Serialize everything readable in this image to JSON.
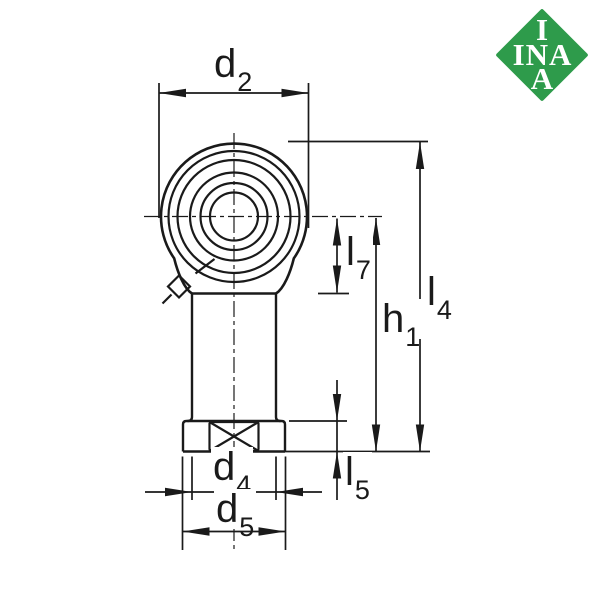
{
  "drawing": {
    "type": "technical-drawing-rod-end-bearing",
    "labels": {
      "d2": {
        "main": "d",
        "sub": "2"
      },
      "l7": {
        "main": "l",
        "sub": "7"
      },
      "h1": {
        "main": "h",
        "sub": "1"
      },
      "l4": {
        "main": "l",
        "sub": "4"
      },
      "l5": {
        "main": "l",
        "sub": "5"
      },
      "d4": {
        "main": "d",
        "sub": "4"
      },
      "d5": {
        "main": "d",
        "sub": "5"
      }
    }
  },
  "logo": {
    "top": "I",
    "middle": "INA",
    "bottom": "A",
    "bg_color": "#2e9b4b",
    "text_color": "#ffffff"
  },
  "colors": {
    "line": "#1a1a1a",
    "background": "#ffffff"
  }
}
